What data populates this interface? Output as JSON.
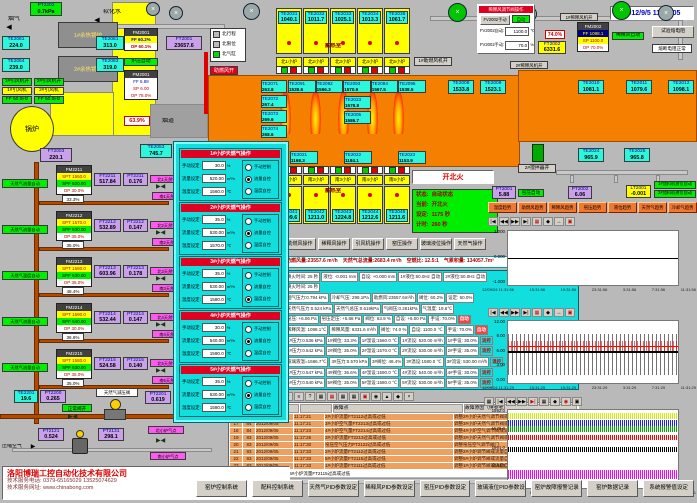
{
  "datetime": "2012/9/5 11:33:05",
  "top_left": {
    "flue_gas_label": "烟气",
    "soft_water_label": "软化水",
    "pt2202": [
      "PT2202",
      "0.7kPa"
    ],
    "boiler1_label": "1#余热锅炉",
    "boiler2_label": "2#余热锅炉",
    "te2061": [
      "TE2061",
      "224.0"
    ],
    "te2064": [
      "TE2064",
      "239.0"
    ],
    "te2081": [
      "TE2081",
      "313.0"
    ],
    "te2083": [
      "TE2083",
      "319.0"
    ],
    "fan1_status": "1#引风机开",
    "fan2_status": "2#引风机开",
    "fan1_label": "1#引风机",
    "fan2_label": "2#引风机",
    "fan1_freq": "FF 50.0Hz",
    "fan2_freq": "FF 50.0Hz",
    "boiler_circle_label": "锅炉",
    "ft2003": [
      "FT2003",
      "220.1"
    ],
    "te2053": [
      "TE2053",
      "745.7"
    ],
    "fm2001_title": "FM2001",
    "fm2001_rows": [
      "FF 60.2%",
      "OP 60.1%"
    ],
    "furnace_pressure_auto": "炉压自动",
    "pm2001_title": "PM2001",
    "pm2001_rows": [
      "FF 5.88",
      "SP 6.00",
      "OP 78.0%"
    ],
    "ft2001": [
      "FT2001",
      "23657.6"
    ],
    "damper_position": "63.9%",
    "flue_label": "烟道",
    "comb_air_open": "助燃风开",
    "legend_items": [
      "北行程",
      "北限位",
      "北气缸"
    ]
  },
  "regen_top": {
    "label": "蓄热室",
    "boxes": [
      [
        "TE2031",
        "1040.1"
      ],
      [
        "TE2032",
        "1011.7"
      ],
      [
        "TE2033",
        "1025.1"
      ],
      [
        "TE2034",
        "1013.3"
      ],
      [
        "TE2035",
        "1061.7"
      ]
    ],
    "burners": [
      "北1小炉",
      "北2小炉",
      "北3小炉",
      "北4小炉",
      "北5小炉"
    ],
    "fan_status": "1#助燃风机开"
  },
  "furnace": {
    "left_temps": [
      [
        "TE2071",
        "263.8"
      ],
      [
        "TE2072",
        "267.4"
      ],
      [
        "TE2073",
        "269.6"
      ],
      [
        "TE2074",
        "268.6"
      ]
    ],
    "crown_temps": [
      [
        "TE2091",
        "1538.6"
      ],
      [
        "TE2092",
        "1566.3"
      ],
      [
        "TE2093",
        "1570.9"
      ],
      [
        "TE2094",
        "1567.5"
      ],
      [
        "TE2095",
        "1538.5"
      ]
    ],
    "mid_temps": [
      [
        "TE2023",
        "1578.8"
      ],
      [
        "TE2005",
        "1586.7"
      ]
    ],
    "bottom_temps": [
      [
        "TE2021",
        "1168.3"
      ],
      [
        "TE2022",
        "1184.1"
      ],
      [
        "TE2023",
        "1153.9"
      ]
    ],
    "right_temps1": [
      "TE2008",
      "1533.8"
    ],
    "right_temps2": [
      "TE2009",
      "1523.1"
    ],
    "te2010": [
      "TE2010",
      "1081.1"
    ],
    "te2011": [
      "TE2011",
      "1079.6"
    ],
    "te2012": [
      "TE2012",
      "1098.1"
    ],
    "te2024": [
      "TE2024",
      "965.9"
    ],
    "te2025": [
      "TE2025",
      "965.8"
    ],
    "stirrer_label": "2#搅拌器开"
  },
  "dilution": {
    "panel_title": "稀释风调节阀操作",
    "manual_btn": "FV2002手动",
    "auto_btn": "自动",
    "auto_label": "FV2002自动:",
    "auto_value": "1100.0",
    "auto_unit": "℃",
    "manual_label": "FV2002手动:",
    "manual_value": "70.0",
    "manual_unit": "%",
    "fm2002_title": "FM2002",
    "fm2002_rows": [
      "PF 1098.1",
      "SP 1100.0",
      "OP 70.0%"
    ],
    "auto_status": "稀释风自动",
    "valve_pos": "74.0%",
    "ft2002": [
      "FT2002",
      "6331.6"
    ],
    "test_btn": "试验熔电阻",
    "fuse_ok": "熔断电阻正常",
    "fan1": "1#稀释风机开",
    "fan2": "2#稀释风机开"
  },
  "south": {
    "burners": [
      "南1小炉",
      "南2小炉",
      "南3小炉",
      "南4小炉",
      "南5小炉"
    ],
    "regen_label": "蓄热室",
    "temps": [
      [
        "TE2041",
        "1209.6"
      ],
      [
        "TE2042",
        "1211.0"
      ],
      [
        "TE2043",
        "1224.8"
      ],
      [
        "TE2044",
        "1212.6"
      ],
      [
        "TE2045",
        "1211.6"
      ]
    ],
    "fire_btn": "开北火",
    "status": [
      [
        "状态:",
        "自动状态"
      ],
      [
        "当前:",
        "开北火"
      ],
      [
        "设定:",
        "1175 秒"
      ],
      [
        "计时:",
        "260 秒"
      ]
    ]
  },
  "gauges_mid": {
    "pt2001": [
      "PT2001",
      "5.88"
    ],
    "kiln_pressure_auto": "窑压自动",
    "pt2002": [
      "PT2002",
      "6.06"
    ],
    "lt2001": [
      "LT2001",
      "-0.001"
    ],
    "feeder1_auto": "1#加料机液位自动",
    "feeder2_auto": "2#加料机液位自动"
  },
  "op_buttons": [
    "助燃风操作",
    "稀释风操作",
    "引风机操作",
    "窑压操作",
    "玻璃液位操作",
    "天然气操作"
  ],
  "trend_buttons": [
    "温度趋势",
    "助燃风趋势",
    "稀释风趋势",
    "窑压趋势",
    "液位趋势",
    "天然气趋势",
    "冷却气趋势"
  ],
  "summary": [
    "助燃风量:23557.6 m³/h",
    "天然气总流量:2683.4 m³/h",
    "空燃比: 12.5:1",
    "气累积量: 134057.7m³"
  ],
  "param_rows": [
    [
      "换火时间: 25 秒",
      "液位: -0.001 mm",
      "自设: +0.000 mm",
      "1#液位:50.0Hz 自动",
      "2#液位:50.0Hz 自动"
    ],
    [
      "换火时间: 25 秒"
    ],
    [
      "烟气压力:0.794 kPa",
      "冷却气压: 298.1Pa",
      "助燃风:23557.6m³/h",
      "阀位: 60.2%",
      "设定: 60.0%"
    ],
    [
      "天然气压力:0.524 kPa",
      "天然气总压:0.619kPa",
      "气阀压:0.261kPa",
      "气温度: 19.6℃"
    ],
    [
      "窑压: +6.06 Pa",
      "窑压定压: +5.88 Pa",
      "阀位: 63.9 %",
      "自设: +6.00 Pa",
      "手设: 70.0%",
      "自动"
    ],
    [
      "稀释风温: 1098.1℃",
      "稀释风量: 6331.6 m³/h",
      "阀位: 74.0 %",
      "自设: 1100.0 ℃",
      "手设: 70.0%",
      "自动"
    ],
    [
      "1#压力:0.536 kPa",
      "1#阀位: 33.3%",
      "1#温设:1560.0 ℃",
      "1#流设: 520.00 m³/h",
      "1#手设: 30.0%",
      "流控"
    ],
    [
      "2#压力:0.542 kPa",
      "2#阀位: 35.0%",
      "2#温设:1570.0 ℃",
      "2#流设: 530.00 m³/h",
      "2#手设: 35.0%",
      "流控"
    ],
    [
      "玻璃液温=1586.7℃",
      "3#压力:0.570 kPa",
      "3#阀位: 48.4%",
      "3#温设:1580.0 ℃",
      "3#流设: 530.00 m³/h",
      "温控"
    ],
    [
      "4#压力:0.547 kPa",
      "4#阀位: 36.6%",
      "4#温设:1590.0 ℃",
      "4#流设: 540.00 m³/h",
      "4#手设: 30.0%",
      "流控"
    ],
    [
      "5#压力:0.540 kPa",
      "5#阀位: 35.0%",
      "5#温设:1580.0 ℃",
      "5#流设: 530.00 m³/h",
      "5#手设: 35.0%",
      "流控"
    ]
  ],
  "popup": {
    "field_labels": [
      "手动设定:",
      "流量设定:",
      "温度设定:"
    ],
    "units": [
      "%",
      "m³/h",
      "℃"
    ],
    "modes": [
      "手动控制",
      "流量自控",
      "温度自控"
    ],
    "panels": [
      {
        "title": "1#小炉天燃气操作",
        "manual": "30.0",
        "flow": "520.00",
        "temp": "1560.0",
        "selected": "1"
      },
      {
        "title": "2#小炉天燃气操作",
        "manual": "35.0",
        "flow": "530.00",
        "temp": "1570.0",
        "selected": "1"
      },
      {
        "title": "3#小炉天燃气操作",
        "manual": "35.0",
        "flow": "530.00",
        "temp": "1580.0",
        "selected": "2"
      },
      {
        "title": "4#小炉天燃气操作",
        "manual": "30.0",
        "flow": "540.00",
        "temp": "1590.0",
        "selected": "1"
      },
      {
        "title": "5#小炉天燃气操作",
        "manual": "35.0",
        "flow": "530.00",
        "temp": "1580.0",
        "selected": "1"
      }
    ]
  },
  "gas": {
    "branches": [
      {
        "mode": "天然气流量自动",
        "fm_title": "FM2211",
        "fm_rows": [
          "SPT 1560.0",
          "SPF 520.00",
          "OP 30.0%"
        ],
        "valve": "33.3%",
        "ft": [
          "FT2211",
          "517.84"
        ],
        "pt": [
          "PT2211",
          "0.176"
        ],
        "north": "北1天然气点",
        "south": "南1天然气点"
      },
      {
        "mode": "天然气流量自动",
        "fm_title": "FM2212",
        "fm_rows": [
          "SPT 1570.0",
          "SPF 530.00",
          "OP 35.0%"
        ],
        "valve": "35.0%",
        "ft": [
          "FT2212",
          "532.89"
        ],
        "pt": [
          "PT2212",
          "0.147"
        ],
        "north": "北2天然气点",
        "south": "南2天然气点"
      },
      {
        "mode": "天然气温度自动",
        "fm_title": "FM2213",
        "fm_rows": [
          "SPT 1580.0",
          "SPF 530.00",
          "OP 35.0%"
        ],
        "valve": "48.4%",
        "ft": [
          "FT2213",
          "603.96"
        ],
        "pt": [
          "PT2213",
          "0.178"
        ],
        "north": "北3天然气点",
        "south": "南3天然气点"
      },
      {
        "mode": "天然气流量自动",
        "fm_title": "FM2214",
        "fm_rows": [
          "SPT 1590.0",
          "SPF 540.00",
          "OP 30.0%"
        ],
        "valve": "36.6%",
        "ft": [
          "FT2214",
          "532.44"
        ],
        "pt": [
          "PT2214",
          "0.147"
        ],
        "north": "北4天然气点",
        "south": "南4天然气点"
      },
      {
        "mode": "天然气流量自动",
        "fm_title": "FM2215",
        "fm_rows": [
          "SPT 1580.0",
          "SPF 530.00",
          "OP 35.0%"
        ],
        "valve": "35.0%",
        "ft": [
          "FT2215",
          "524.58"
        ],
        "pt": [
          "PT2215",
          "0.140"
        ],
        "north": "北5天然气点",
        "south": "南5天然气点"
      }
    ],
    "main": {
      "te2201": [
        "TE2201",
        "19.6"
      ],
      "pt2200": [
        "PT2200",
        "0.265"
      ],
      "valve_status": "正常阀开",
      "reducer_label": "天然气减压阀",
      "pt2201": [
        "PT2201",
        "0.619"
      ]
    },
    "air": {
      "label": "压缩空气",
      "pt2121": [
        "PT2121",
        "0.524"
      ],
      "pt2131": [
        "PT2131",
        "298.1"
      ],
      "north": "北小炉气点",
      "south": "南小炉气点"
    }
  },
  "chart_toolbar": [
    "|◀",
    "◀◀",
    "▶▶",
    "▶|",
    "▦",
    "◆",
    "↔",
    "▣"
  ],
  "chart_toolbar3": [
    "▦",
    "|◀",
    "◀◀",
    "▶▶",
    "▶|",
    "▦",
    "◆",
    "◉",
    "▣"
  ],
  "table_toolbar": [
    "▼",
    "≡",
    "?",
    "▦",
    "▦",
    "▦",
    "▦",
    "▣",
    "◉",
    "▲",
    "◆",
    "×"
  ],
  "chart_data": [
    {
      "type": "line",
      "title": "玻璃液位趋势",
      "ylim": [
        -1,
        1
      ],
      "yticks": [
        "1.000",
        "0.000",
        "-1.000"
      ],
      "xticks": [
        "12/09/04 11:31:56",
        "15:31:56",
        "19:31:56",
        "23:31:56",
        "3:31:56",
        "7:31:56",
        "11:31:56"
      ],
      "series": [
        {
          "name": "液位",
          "color": "#000000",
          "approx_value": 0.0
        }
      ],
      "legend_position": "none",
      "grid": false
    },
    {
      "type": "line",
      "title": "窑压趋势",
      "ylim": [
        0,
        12
      ],
      "yticks": [
        "12.00",
        "9.00",
        "6.00",
        "3.00",
        "0.00"
      ],
      "xticks": [
        "12/09/04 11:31:29",
        "15:31:29",
        "19:31:29",
        "23:31:29",
        "3:31:29",
        "7:31:29",
        "11:31:29"
      ],
      "series": [
        {
          "name": "窑压设定",
          "color": "#ff0000",
          "approx_value": 7.0,
          "noise_range": [
            6.5,
            9.5
          ]
        },
        {
          "name": "窑压测量",
          "color": "#000000",
          "approx_value": 6.0,
          "noise_range": [
            1.5,
            9.0
          ]
        }
      ],
      "legend_position": "none",
      "grid": false
    },
    {
      "type": "line",
      "title": "窑温趋势",
      "ylim": [
        1527,
        1592
      ],
      "yticks": [
        "1592.0",
        "1578.0",
        "1561.0",
        "1544.0",
        "1527.0"
      ],
      "xticks": [
        "12/09/04 11:32:51",
        "15:32:51",
        "19:32:51",
        "23:32:51",
        "3:32:51",
        "7:32:51",
        "11:32:51"
      ],
      "series": [
        {
          "name": "温度1",
          "color": "#c8f000",
          "approx_value": 1588
        },
        {
          "name": "温度2",
          "color": "#2020ff",
          "approx_value": 1581
        },
        {
          "name": "温度3",
          "color": "#00a800",
          "approx_value": 1576
        },
        {
          "name": "温度4",
          "color": "#ff0000",
          "approx_value": 1569
        },
        {
          "name": "温度5",
          "color": "#000000",
          "approx_value": 1559
        },
        {
          "name": "温度6",
          "color": "#ff00ff",
          "approx_value": 1537
        }
      ],
      "legend_position": "none",
      "grid": false
    }
  ],
  "alarm_table": {
    "headers": [
      "",
      "",
      "",
      "",
      "故障点",
      "故障原因（供参考）"
    ],
    "rows": [
      [
        "16",
        "98",
        "2012/09/05",
        "11:17:21",
        "2#小炉流量FT2112过高或过低",
        "调整2#小炉天然气调节阀或减小阀门"
      ],
      [
        "17",
        "84",
        "2012/09/05",
        "11:17:21",
        "3#小炉空气量FT2213过高或过低",
        "调整3#小炉天然气调节阀或减小阀门"
      ],
      [
        "18",
        "84",
        "2012/09/05",
        "11:17:23",
        "4#小炉空气量FT2214过高或过低",
        "调整4#小炉空气调节阀或减小阀门"
      ],
      [
        "19",
        "83",
        "2012/09/05",
        "11:17:26",
        "3#小炉流量FT2213过高或过低",
        "调整3#小炉天然气调节阀或流量自动阀"
      ],
      [
        "20",
        "83",
        "2012/09/05",
        "11:17:30",
        "窑压空气压力PT2122过高或过低",
        "调整窑压空气调节阀门"
      ],
      [
        "21",
        "83",
        "2012/09/05",
        "11:17:33",
        "2#小炉流量FT2112过高或过低",
        "调整2#小炉调节阀或流量自动调节阀"
      ],
      [
        "22",
        "83",
        "2012/09/05",
        "11:17:33",
        "5#小炉流量FT2115过高或过低",
        "调整5#小炉调节阀或流量自动调节阀"
      ],
      [
        "23",
        "83",
        "2012/09/05",
        "11:17:33",
        "1#小炉流量FT2111过高或过低",
        "调整1#小炉调节阀或流量自动调节阀"
      ]
    ],
    "last_row": "▶ 23   83   2012/09/05  11:17:33  5#小炉流量FT2115过高或过低"
  },
  "company": {
    "name": "洛阳博瑞工控自动化技术有限公司",
    "phone": "技术服务电话: 0379-65165029  13525074629",
    "web": "技术服务网址: www.chinabong.com"
  },
  "bottom_buttons": [
    "窑炉控制系统",
    "配料控制系统",
    "天然气PID参数设定",
    "稀释风PID参数设定",
    "窑压PID参数设定",
    "玻璃液位PID参数设定",
    "窑炉故障报警记录",
    "窑炉数据记录",
    "系统报警值设定"
  ]
}
